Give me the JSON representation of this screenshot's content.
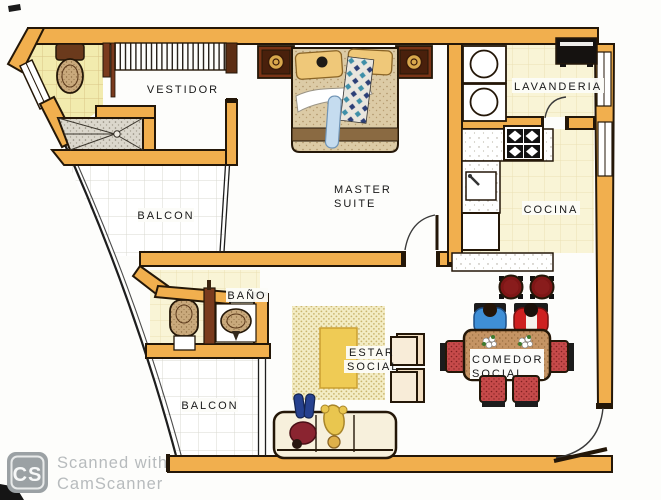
{
  "document": {
    "kind": "apartment floor plan (scanned)",
    "rooms": {
      "vestidor": {
        "label": "VESTIDOR"
      },
      "balcon_upper": {
        "label": "BALCON"
      },
      "master_suite": {
        "line1": "MASTER",
        "line2": "SUITE"
      },
      "lavanderia": {
        "label": "LAVANDERIA"
      },
      "cocina": {
        "label": "COCINA"
      },
      "bano": {
        "label": "BAÑO"
      },
      "estar_social": {
        "line1": "ESTAR",
        "line2": "SOCIAL"
      },
      "comedor_social": {
        "line1": "COMEDOR",
        "line2": "SOCIAL"
      },
      "balcon_lower": {
        "label": "BALCON"
      }
    },
    "watermark": {
      "logo": "CS",
      "line1": "Scanned with",
      "line2": "CamScanner"
    },
    "colors": {
      "wall": "#F1AF4E",
      "wall_outline": "#241708",
      "tile_yellow": "#F2EBAE",
      "tile_cream": "#F9F4D6",
      "tile_white": "#FFFFFF",
      "rug": "#F3ECC4",
      "coffee_table": "#EFCB55",
      "dining_chair_red": "#C64A4A",
      "stool_red": "#7E1616",
      "person_blue": "#3F8FD6",
      "person_red": "#CE2020",
      "watermark_gray": "#B7BBBD"
    }
  }
}
